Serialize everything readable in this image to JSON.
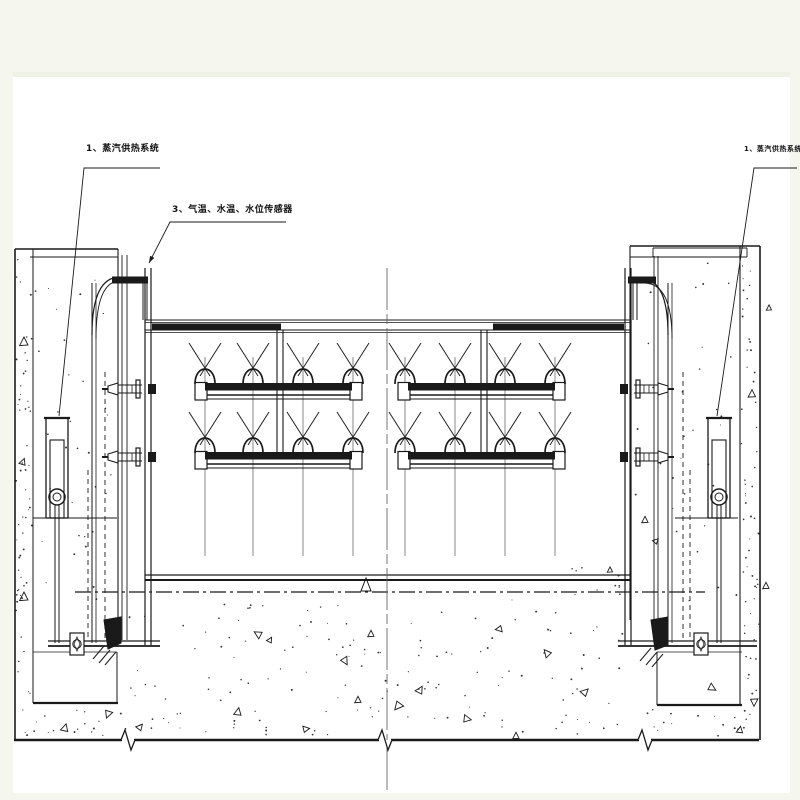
{
  "page": {
    "background": "#f5f7ef",
    "sheet_color": "#ffffff",
    "line_color": "#1a1a1a",
    "centerline_color": "#666666"
  },
  "labels": {
    "steam_left": {
      "text": "1、蒸汽供热系统"
    },
    "steam_right": {
      "text": "1、蒸汽供热系统"
    },
    "sensors": {
      "text": "3、气温、水温、水位传感器"
    }
  },
  "drawing": {
    "sheet": {
      "x": 13,
      "y": 77,
      "w": 777,
      "h": 716
    },
    "leaders": [
      {
        "name": "steam-left-leader",
        "pts": [
          [
            160,
            168
          ],
          [
            84,
            168
          ],
          [
            59,
            416
          ]
        ],
        "arrow": false
      },
      {
        "name": "steam-right-leader",
        "pts": [
          [
            797,
            168
          ],
          [
            754,
            168
          ],
          [
            717,
            416
          ]
        ],
        "arrow": false
      },
      {
        "name": "sensors-leader",
        "pts": [
          [
            286,
            222
          ],
          [
            170,
            222
          ],
          [
            149,
            263
          ]
        ],
        "arrow": true
      }
    ],
    "lines": [
      [
        15,
        249,
        15,
        740,
        1.6
      ],
      [
        33,
        249,
        33,
        703,
        1
      ],
      [
        118,
        249,
        118,
        620,
        1.1
      ],
      [
        15,
        249,
        118,
        249,
        1.6
      ],
      [
        30,
        257,
        118,
        257,
        0.9
      ],
      [
        33,
        703,
        118,
        703,
        2.2
      ],
      [
        117,
        652,
        117,
        703,
        1
      ],
      [
        33,
        652,
        117,
        652,
        0.8
      ],
      [
        33,
        518,
        117,
        518,
        1
      ],
      [
        92,
        283,
        92,
        643,
        1
      ],
      [
        96,
        283,
        96,
        643,
        0.8
      ],
      [
        122,
        255,
        122,
        640,
        0.9
      ],
      [
        127,
        255,
        127,
        640,
        0.9
      ],
      [
        105,
        372,
        105,
        640,
        0.9,
        "hid"
      ],
      [
        88,
        470,
        88,
        640,
        0.9,
        "hid"
      ],
      [
        143,
        283,
        143,
        320,
        1
      ],
      [
        147,
        283,
        147,
        320,
        1
      ],
      [
        630,
        246,
        630,
        620,
        1.1
      ],
      [
        654,
        256,
        654,
        640,
        0.9
      ],
      [
        658,
        256,
        658,
        640,
        0.9
      ],
      [
        740,
        246,
        740,
        705,
        1.1
      ],
      [
        760,
        246,
        760,
        740,
        1.6
      ],
      [
        630,
        246,
        760,
        246,
        1.6
      ],
      [
        630,
        257,
        747,
        257,
        0.9
      ],
      [
        653,
        248,
        747,
        248,
        0.9
      ],
      [
        653,
        248,
        653,
        257,
        0.9
      ],
      [
        747,
        248,
        747,
        257,
        0.9
      ],
      [
        657,
        705,
        742,
        705,
        2.2
      ],
      [
        657,
        652,
        657,
        705,
        1
      ],
      [
        657,
        652,
        742,
        652,
        0.8
      ],
      [
        675,
        518,
        738,
        518,
        1
      ],
      [
        668,
        283,
        668,
        643,
        1
      ],
      [
        672,
        283,
        672,
        643,
        0.8
      ],
      [
        683,
        372,
        683,
        640,
        0.9,
        "hid"
      ],
      [
        690,
        470,
        690,
        640,
        0.9,
        "hid"
      ],
      [
        633,
        283,
        633,
        320,
        1
      ],
      [
        637,
        283,
        637,
        320,
        1
      ],
      [
        145,
        268,
        145,
        645,
        1.2
      ],
      [
        151,
        268,
        151,
        645,
        1.2
      ],
      [
        625,
        268,
        625,
        645,
        1.2
      ],
      [
        631,
        268,
        631,
        645,
        1.2
      ],
      [
        145,
        320,
        631,
        320,
        1.1
      ],
      [
        145,
        322.5,
        631,
        322.5,
        0.7
      ],
      [
        145,
        330,
        631,
        330,
        1.1
      ],
      [
        145,
        332.5,
        631,
        332.5,
        0.7
      ],
      [
        145,
        575,
        631,
        575,
        1.3
      ],
      [
        145,
        580,
        631,
        580,
        2
      ],
      [
        277,
        330,
        277,
        452,
        1.1
      ],
      [
        283,
        330,
        283,
        452,
        1.1
      ],
      [
        481,
        330,
        481,
        452,
        1.1
      ],
      [
        487,
        330,
        487,
        452,
        1.1
      ],
      [
        48,
        641,
        160,
        641,
        1.3
      ],
      [
        48,
        646,
        160,
        646,
        1.8
      ],
      [
        618,
        641,
        757,
        641,
        1.3
      ],
      [
        618,
        646,
        757,
        646,
        1.8
      ],
      [
        75,
        592,
        705,
        592,
        1.3,
        "chain"
      ],
      [
        387,
        268,
        387,
        792,
        0.9,
        "center",
        "#666"
      ],
      [
        14,
        740,
        122,
        740,
        2.4
      ],
      [
        134,
        740,
        379,
        740,
        2.4
      ],
      [
        391,
        740,
        639,
        740,
        2.4
      ],
      [
        651,
        740,
        759,
        740,
        2.4
      ]
    ],
    "fill_rects": [
      [
        112,
        276.5,
        36,
        7
      ],
      [
        628,
        276.5,
        28,
        7
      ],
      [
        152,
        323.5,
        129,
        6.5
      ],
      [
        493,
        323.5,
        131,
        6.5
      ]
    ],
    "paths": [
      {
        "d": "M92,335 Q92,277 120,277",
        "w": 1.2
      },
      {
        "d": "M96,339 Q96,281 120,281",
        "w": 0.9
      },
      {
        "d": "M668,335 Q668,279 642,279",
        "w": 1.2
      },
      {
        "d": "M672,339 Q672,283 644,283",
        "w": 0.9
      },
      {
        "d": "M366,578 L361,591 L371,591 Z",
        "w": 1
      },
      {
        "d": "M104,620 L121,617 L121,643 L108,649 Z",
        "fill": true
      },
      {
        "d": "M651,620 L668,617 L668,645 L655,650 Z",
        "fill": true
      },
      {
        "d": "M104,646 L93,659",
        "w": 1
      },
      {
        "d": "M110,650 L99,663",
        "w": 1
      },
      {
        "d": "M116,652 L105,665",
        "w": 1
      },
      {
        "d": "M651,648 L640,661",
        "w": 1
      },
      {
        "d": "M657,652 L646,665",
        "w": 1
      },
      {
        "d": "M663,654 L652,667",
        "w": 1
      }
    ],
    "breaks": {
      "y": 740,
      "xs": [
        128,
        385,
        645
      ]
    },
    "spray": {
      "rows": [
        383,
        452
      ],
      "groups": [
        {
          "cap1": 195,
          "cap2": 350,
          "nozzles": [
            205,
            253,
            303,
            353
          ]
        },
        {
          "cap1": 398,
          "cap2": 553,
          "nozzles": [
            405,
            455,
            505,
            555
          ]
        }
      ],
      "cap_w": 12,
      "cap_h": 17,
      "hanger_top": 357,
      "hanger_bottom": 556
    },
    "cylinders": [
      {
        "cx": 57
      },
      {
        "cx": 719
      }
    ],
    "cylinder_spec": {
      "top": 418,
      "body_w": 22,
      "body_h": 100,
      "inner_top": 440,
      "eye_y": 497,
      "eye_r": 8,
      "rod_bottom": 643
    },
    "connectors": [
      {
        "edge": 148,
        "cy": 389,
        "dir": -1
      },
      {
        "edge": 148,
        "cy": 457,
        "dir": -1
      },
      {
        "edge": 628,
        "cy": 389,
        "dir": 1
      },
      {
        "edge": 628,
        "cy": 457,
        "dir": 1
      }
    ],
    "sill_bolts": [
      {
        "x": 77
      },
      {
        "x": 701
      }
    ],
    "stipple": {
      "seed": 42,
      "regions": [
        {
          "x": 16,
          "y": 252,
          "w": 16,
          "h": 486,
          "n": 60
        },
        {
          "x": 34,
          "y": 262,
          "w": 82,
          "h": 340,
          "n": 34
        },
        {
          "x": 741,
          "y": 250,
          "w": 18,
          "h": 488,
          "n": 60
        },
        {
          "x": 634,
          "y": 262,
          "w": 104,
          "h": 340,
          "n": 34
        },
        {
          "x": 120,
          "y": 600,
          "w": 508,
          "h": 135,
          "n": 150
        },
        {
          "x": 34,
          "y": 708,
          "w": 82,
          "h": 28,
          "n": 14
        },
        {
          "x": 632,
          "y": 708,
          "w": 106,
          "h": 28,
          "n": 14
        },
        {
          "x": 560,
          "y": 562,
          "w": 66,
          "h": 34,
          "n": 10
        }
      ]
    },
    "triangles": [
      [
        24,
        342,
        8,
        0
      ],
      [
        23,
        462,
        6,
        20
      ],
      [
        24,
        597,
        8,
        0
      ],
      [
        65,
        728,
        7,
        15
      ],
      [
        108,
        714,
        7,
        200
      ],
      [
        140,
        727,
        6,
        40
      ],
      [
        238,
        712,
        7,
        10
      ],
      [
        258,
        634,
        7,
        300
      ],
      [
        306,
        729,
        6,
        80
      ],
      [
        345,
        661,
        7,
        150
      ],
      [
        358,
        700,
        6,
        0
      ],
      [
        398,
        706,
        8,
        220
      ],
      [
        420,
        690,
        7,
        30
      ],
      [
        467,
        719,
        7,
        100
      ],
      [
        499,
        629,
        6,
        260
      ],
      [
        516,
        736,
        6,
        0
      ],
      [
        547,
        653,
        7,
        320
      ],
      [
        585,
        692,
        7,
        45
      ],
      [
        610,
        570,
        5,
        0
      ],
      [
        712,
        688,
        7,
        120
      ],
      [
        740,
        730,
        6,
        10
      ],
      [
        752,
        394,
        7,
        0
      ],
      [
        754,
        702,
        7,
        180
      ],
      [
        769,
        308,
        5,
        0
      ],
      [
        766,
        586,
        6,
        0
      ],
      [
        645,
        520,
        6,
        0
      ],
      [
        656,
        541,
        5,
        45
      ],
      [
        371,
        634,
        6,
        0
      ],
      [
        270,
        640,
        5,
        30
      ]
    ]
  }
}
